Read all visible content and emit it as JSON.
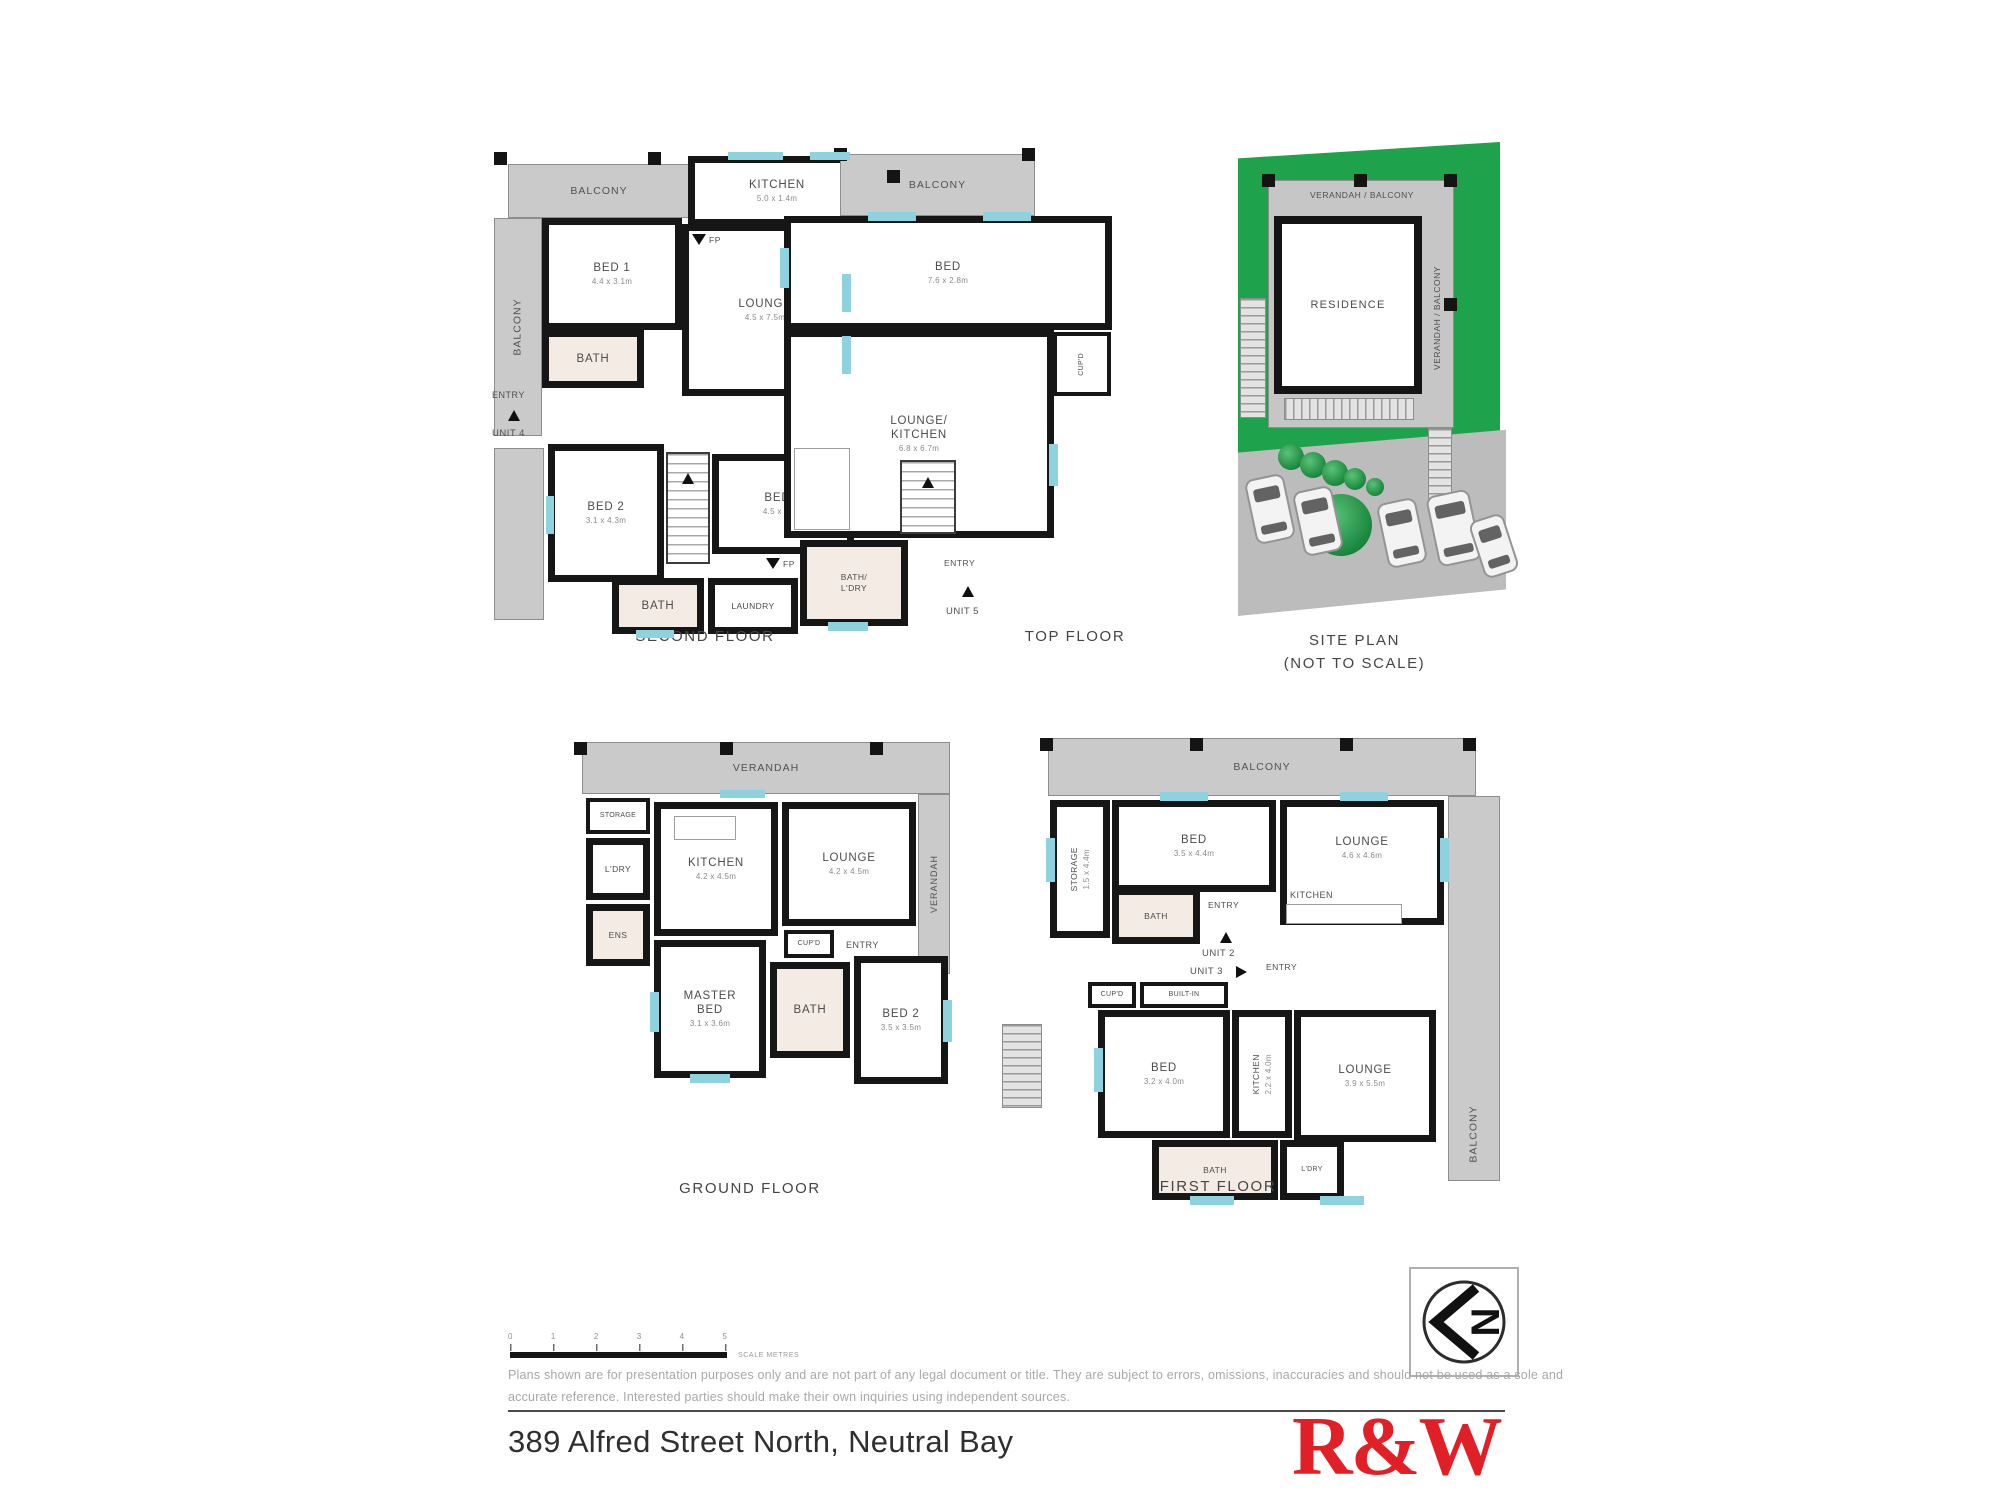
{
  "plans": {
    "second_floor": {
      "caption": "SECOND FLOOR",
      "balcony_top": "BALCONY",
      "balcony_left": "BALCONY",
      "balcony_right": "BALCONY",
      "kitchen": {
        "name": "KITCHEN",
        "dims": "5.0 x 1.4m"
      },
      "fp_top": "FP",
      "bed1": {
        "name": "BED 1",
        "dims": "4.4 x 3.1m"
      },
      "lounge": {
        "name": "LOUNGE",
        "dims": "4.5 x 7.5m"
      },
      "bath_upper": "BATH",
      "entry": "ENTRY",
      "unit": "UNIT 4",
      "bed2": {
        "name": "BED 2",
        "dims": "3.1 x 4.3m"
      },
      "bed3": {
        "name": "BED 3",
        "dims": "4.5 x 2.8m"
      },
      "fp_bottom": "FP",
      "bath_lower": "BATH",
      "laundry": "LAUNDRY"
    },
    "top_floor": {
      "caption": "TOP FLOOR",
      "balcony": "BALCONY",
      "bed": {
        "name": "BED",
        "dims": "7.6 x 2.8m"
      },
      "cupboard": "CUP'D",
      "lounge_kitchen": {
        "name": "LOUNGE/",
        "name2": "KITCHEN",
        "dims": "6.8 x 6.7m"
      },
      "bath_laundry": {
        "name": "BATH/",
        "name2": "L'DRY"
      },
      "entry": "ENTRY",
      "unit": "UNIT 5"
    },
    "site_plan": {
      "caption_line1": "SITE PLAN",
      "caption_line2": "(NOT TO SCALE)",
      "verandah_top": "VERANDAH / BALCONY",
      "verandah_right": "VERANDAH / BALCONY",
      "residence": "RESIDENCE"
    },
    "ground_floor": {
      "caption": "GROUND FLOOR",
      "verandah_top": "VERANDAH",
      "verandah_right": "VERANDAH",
      "unit": "UNIT 1",
      "storage": "STORAGE",
      "laundry": "L'DRY",
      "ensuite": "ENS",
      "kitchen": {
        "name": "KITCHEN",
        "dims": "4.2 x 4.5m"
      },
      "lounge": {
        "name": "LOUNGE",
        "dims": "4.2 x 4.5m"
      },
      "entry": "ENTRY",
      "cupboard": "CUP'D",
      "master_bed": {
        "name": "MASTER",
        "name2": "BED",
        "dims": "3.1 x 3.6m"
      },
      "bath": "BATH",
      "bed2": {
        "name": "BED 2",
        "dims": "3.5 x 3.5m"
      }
    },
    "first_floor": {
      "caption": "FIRST FLOOR",
      "balcony_top": "BALCONY",
      "balcony_right": "BALCONY",
      "storage": {
        "name": "STORAGE",
        "dims": "1.5 x 4.4m"
      },
      "bed_upper": {
        "name": "BED",
        "dims": "3.5 x 4.4m"
      },
      "lounge_upper": {
        "name": "LOUNGE",
        "dims": "4.6 x 4.6m"
      },
      "bath_upper": "BATH",
      "entry_upper": "ENTRY",
      "kitchen_upper": "KITCHEN",
      "unit2": "UNIT 2",
      "unit3": "UNIT 3",
      "entry_lower": "ENTRY",
      "cupboard": "CUP'D",
      "builtin": "BUILT-IN",
      "bed_lower": {
        "name": "BED",
        "dims": "3.2 x 4.0m"
      },
      "kitchen_lower": {
        "name": "KITCHEN",
        "dims": "2.2 x 4.0m"
      },
      "lounge_lower": {
        "name": "LOUNGE",
        "dims": "3.9 x 5.5m"
      },
      "bath_lower": "BATH",
      "laundry": "L'DRY"
    }
  },
  "footer": {
    "scale_ticks": [
      "0",
      "1",
      "2",
      "3",
      "4",
      "5"
    ],
    "scale_label": "SCALE METRES",
    "disclaimer_line1": "Plans shown are for presentation purposes only and are not part of any legal document or title. They are subject to errors, omissions, inaccuracies and should not be used as a sole and",
    "disclaimer_line2": "accurate reference. Interested parties should make their own inquiries using independent sources.",
    "address": "389 Alfred Street North, Neutral Bay",
    "brand": "R&W",
    "compass_letter": "N"
  },
  "colors": {
    "brand_red": "#e01f26",
    "lawn_green": "#1ea24b",
    "balcony_grey": "#cacaca",
    "window_blue": "#8ed1df",
    "wall_black": "#161616"
  }
}
